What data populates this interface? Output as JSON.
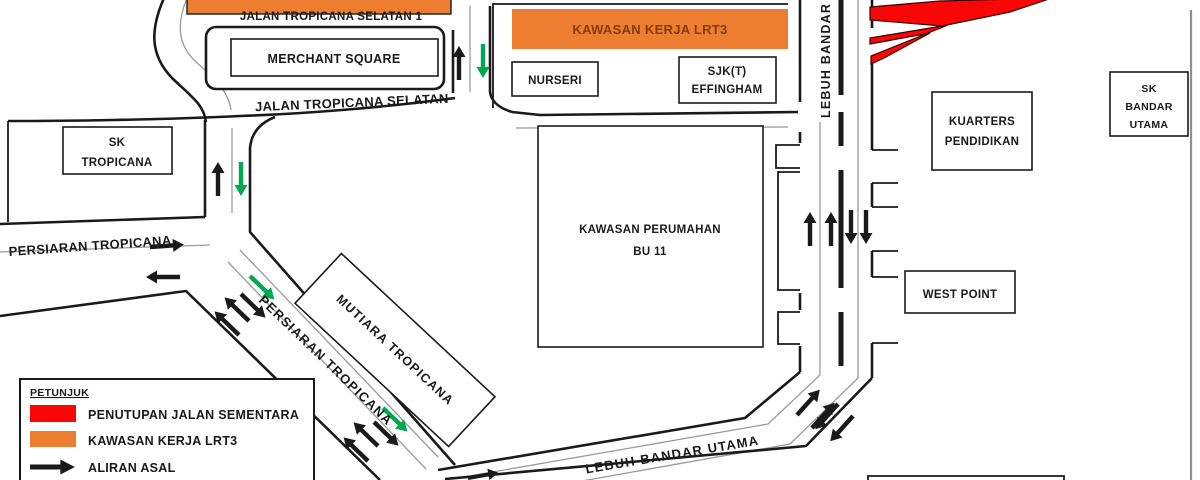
{
  "colors": {
    "ink": "#1a1a1a",
    "thin_gray": "#9a9a9a",
    "frame_gray": "#8f8f8f",
    "closure_red": "#f90606",
    "work_orange": "#ED7D31",
    "work_text": "#843C0C",
    "flow_green": "#00A94F"
  },
  "roads": {
    "jalan_tropicana_selatan_1": "JALAN TROPICANA SELATAN 1",
    "jalan_tropicana_selatan": "JALAN TROPICANA SELATAN",
    "persiaran_tropicana": "PERSIARAN TROPICANA",
    "persiaran_tropicana_diagonal": "PERSIARAN TROPICANA",
    "lebuh_bandar_utama_vertical": "LEBUH BANDAR UTAMA",
    "lebuh_bandar_utama_bottom": "LEBUH BANDAR UTAMA"
  },
  "places": {
    "merchant_square": "MERCHANT SQUARE",
    "kawasan_kerja_lrt3": "KAWASAN KERJA LRT3",
    "nurseri": "NURSERI",
    "sjkt_effingham_1": "SJK(T)",
    "sjkt_effingham_2": "EFFINGHAM",
    "sk_tropicana_1": "SK",
    "sk_tropicana_2": "TROPICANA",
    "kawasan_perumahan_1": "KAWASAN PERUMAHAN",
    "kawasan_perumahan_2": "BU 11",
    "kuarters_pendidikan_1": "KUARTERS",
    "kuarters_pendidikan_2": "PENDIDIKAN",
    "sk_bandar_utama_1": "SK",
    "sk_bandar_utama_2": "BANDAR",
    "sk_bandar_utama_3": "UTAMA",
    "west_point": "WEST POINT",
    "mutiara_tropicana": "MUTIARA TROPICANA"
  },
  "legend": {
    "title": "PETUNJUK",
    "items": [
      {
        "swatch": "red-rect",
        "label": "PENUTUPAN JALAN SEMENTARA"
      },
      {
        "swatch": "orange-rect",
        "label": "KAWASAN KERJA LRT3"
      },
      {
        "swatch": "black-arrow",
        "label": "ALIRAN ASAL"
      }
    ]
  }
}
